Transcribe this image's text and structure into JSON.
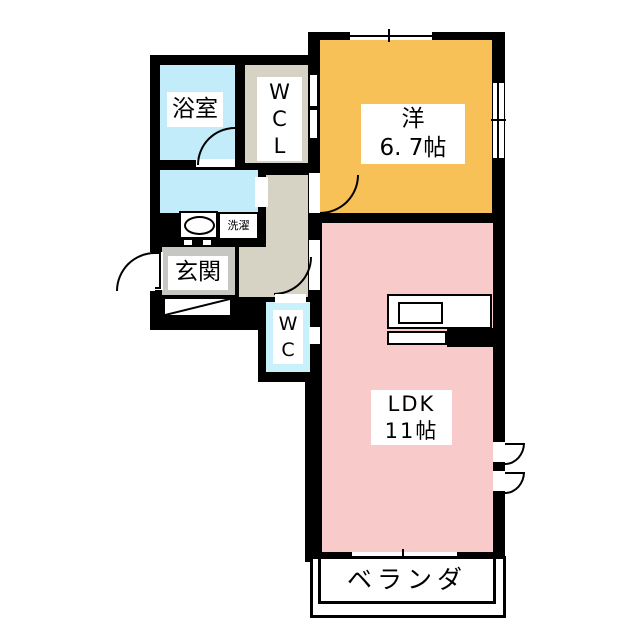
{
  "floorplan": {
    "background_color": "#ffffff",
    "wall_color": "#000000",
    "rooms": {
      "bathroom": {
        "label": "浴室",
        "color": "#c3ecfa"
      },
      "walk_in_closet": {
        "label": "W\nC\nL",
        "color": "#d6d2c4"
      },
      "western_room": {
        "label": "洋\n6. 7帖",
        "size_tatami": "6.7帖",
        "color": "#f7c157"
      },
      "washroom": {
        "color": "#c3ecfa"
      },
      "hallway": {
        "color": "#d6d2c4"
      },
      "entrance": {
        "label": "玄関",
        "color": "#c6c6c3"
      },
      "toilet": {
        "label": "W\nC",
        "color": "#c8f1fb"
      },
      "ldk": {
        "label": "LDK\n11帖",
        "size_tatami": "11帖",
        "color": "#f8caca"
      },
      "veranda": {
        "label": "ベランダ"
      }
    },
    "fixtures": {
      "washing_machine": {
        "label": "洗濯"
      },
      "washbasin": {
        "icon": "washbasin-oval-icon"
      },
      "kitchen": {
        "icon": "kitchen-counter-sink-icon"
      }
    }
  }
}
